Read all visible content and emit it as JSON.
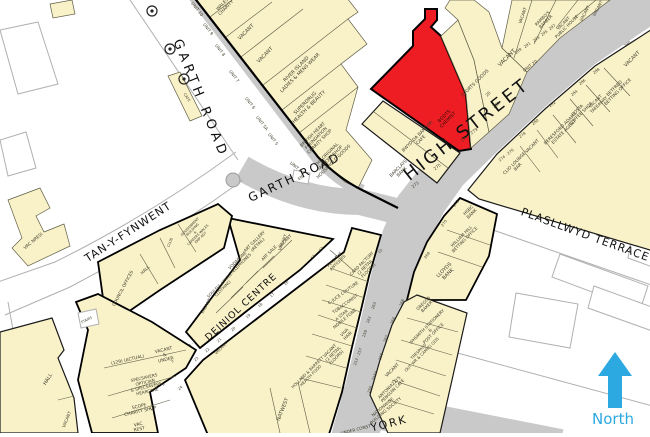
{
  "title": "Goad style retail plan - Bangor High Street",
  "palette": {
    "building": "#f9f2c9",
    "highlight": "#ee1c23",
    "road": "#c9c9c9",
    "north": "#2da9e1",
    "outline": "#5f5d45",
    "label": "#3f3c2a",
    "street": "#111111",
    "casing": "#b0b0b0"
  },
  "north": {
    "label": "North"
  },
  "highlighted_unit": {
    "name": "BOOTS CHEMIST",
    "address": "277 - 279 HIGH STREET"
  },
  "map": {
    "streets": [
      "GARTH ROAD",
      "HIGH STREET",
      "TAN-Y-FYNWENT",
      "PLASLLWYD TERRACE",
      "DEINIOL CENTRE",
      "YORK"
    ],
    "labels": [
      {
        "t": "GARTH ROAD",
        "x": 197,
        "y": 100,
        "r": 68,
        "s": 13,
        "ls": 4,
        "c": "#111111",
        "n": "street-label-garth-road-upper"
      },
      {
        "t": "GARTH ROAD",
        "x": 296,
        "y": 181,
        "r": -25,
        "s": 12,
        "ls": 2,
        "c": "#111111",
        "n": "street-label-garth-road"
      },
      {
        "t": "HIGH STREET",
        "x": 470,
        "y": 134,
        "r": -38,
        "s": 18,
        "ls": 3,
        "c": "#111111",
        "n": "street-label-high-street"
      },
      {
        "t": "TAN-Y-FYNWENT",
        "x": 130,
        "y": 235,
        "r": -33,
        "s": 11,
        "ls": 1,
        "c": "#111111",
        "n": "street-label-tan-y-fynwent"
      },
      {
        "t": "PLASLLWYD TERRACE",
        "x": 584,
        "y": 238,
        "r": 20,
        "s": 11,
        "ls": 1,
        "c": "#111111",
        "n": "street-label-plasllwyd-terrace"
      },
      {
        "t": "DEINIOL CENTRE",
        "x": 243,
        "y": 309,
        "r": -43,
        "s": 9.5,
        "ls": 1,
        "c": "#111111",
        "n": "street-label-deiniol-centre"
      },
      {
        "t": "YORK",
        "x": 390,
        "y": 427,
        "r": -14,
        "s": 11,
        "ls": 2,
        "c": "#111111",
        "n": "street-label-york"
      },
      {
        "t": "UNDER CONST",
        "x": 356,
        "y": 431,
        "r": -14,
        "s": 4.2,
        "n": "label-under-const"
      },
      {
        "t": "North",
        "x": 613,
        "y": 424,
        "r": 0,
        "s": 15,
        "c": "#2da9e1",
        "n": "north-label"
      },
      {
        "t": "WALES\nCHARITY",
        "x": 225,
        "y": 7,
        "r": -45,
        "s": 4.4
      },
      {
        "t": "VACANT",
        "x": 247,
        "y": 33,
        "r": -45,
        "s": 5
      },
      {
        "t": "VACANT",
        "x": 266,
        "y": 56,
        "r": -45,
        "s": 5
      },
      {
        "t": "RIVER ISLAND\nLADIES & MENS WEAR",
        "x": 299,
        "y": 72,
        "r": -45,
        "s": 4.8
      },
      {
        "t": "SUPERDRUG\nHEALTH & BEAUTY",
        "x": 308,
        "y": 106,
        "r": -45,
        "s": 4.8
      },
      {
        "t": "BRITISH HEART\nFOUNDATION\nCHARITY SHOP",
        "x": 317,
        "y": 139,
        "r": -45,
        "s": 4.4
      },
      {
        "t": "THE ORIGINAL\nFACTORY SHOP\nHOUSEHOLD GOODS",
        "x": 331,
        "y": 159,
        "r": -45,
        "s": 4.4
      },
      {
        "t": "UNIT 10",
        "x": 196,
        "y": 10,
        "r": 52,
        "s": 4.2
      },
      {
        "t": "UNIT 9",
        "x": 207,
        "y": 30,
        "r": 52,
        "s": 4.2
      },
      {
        "t": "UNIT 8",
        "x": 219,
        "y": 51,
        "r": 52,
        "s": 4.2
      },
      {
        "t": "UNIT 7",
        "x": 233,
        "y": 77,
        "r": 52,
        "s": 4.2
      },
      {
        "t": "UNIT 6",
        "x": 249,
        "y": 104,
        "r": 52,
        "s": 4.2
      },
      {
        "t": "UNIT 5A",
        "x": 261,
        "y": 124,
        "r": 52,
        "s": 4.2
      },
      {
        "t": "UNIT 5",
        "x": 272,
        "y": 140,
        "r": 52,
        "s": 4.2
      },
      {
        "t": "UNIT 4",
        "x": 295,
        "y": 168,
        "r": 40,
        "s": 4.2
      },
      {
        "t": "CAFE",
        "x": 186,
        "y": 98,
        "r": 56,
        "s": 3.6
      },
      {
        "t": "BOOTS\nCHEMIST",
        "x": 447,
        "y": 119,
        "r": -45,
        "s": 4.6,
        "c": "#2b0d08",
        "n": "highlight-label-boots-chemist"
      },
      {
        "t": "277 - 279",
        "x": 470,
        "y": 136,
        "r": -38,
        "s": 4.2
      },
      {
        "t": "BWYD DA BANGOR\nCAFE",
        "x": 420,
        "y": 139,
        "r": -45,
        "s": 4.4
      },
      {
        "t": "275",
        "x": 438,
        "y": 168,
        "r": -38,
        "s": 4.2
      },
      {
        "t": "BARCLAYS\nBANK",
        "x": 401,
        "y": 171,
        "r": -45,
        "s": 4.4
      },
      {
        "t": "273",
        "x": 416,
        "y": 186,
        "r": -38,
        "s": 4.2
      },
      {
        "t": "SPORTS GOODS",
        "x": 476,
        "y": 84,
        "r": -45,
        "s": 4.6
      },
      {
        "t": "20",
        "x": 489,
        "y": 95,
        "r": -45,
        "s": 4.2
      },
      {
        "t": "281",
        "x": 497,
        "y": 106,
        "r": -38,
        "s": 4.2
      },
      {
        "t": "VACANT",
        "x": 508,
        "y": 59,
        "r": -45,
        "s": 5.5
      },
      {
        "t": "UNIT 20",
        "x": 531,
        "y": 67,
        "r": -38,
        "s": 4.2
      },
      {
        "t": "VACANT",
        "x": 524,
        "y": 16,
        "r": -70,
        "s": 4.2
      },
      {
        "t": "RAMBO'S\nBARBER",
        "x": 545,
        "y": 21,
        "r": -45,
        "s": 4.2
      },
      {
        "t": "VACANT\nPUBLIC HOUSE",
        "x": 566,
        "y": 26,
        "r": -45,
        "s": 4.2
      },
      {
        "t": "VACANT",
        "x": 586,
        "y": 14,
        "r": -62,
        "s": 4.2
      },
      {
        "t": "VACANT",
        "x": 599,
        "y": 9,
        "r": -62,
        "s": 4.2
      },
      {
        "t": "VACANT",
        "x": 633,
        "y": 60,
        "r": -45,
        "s": 5
      },
      {
        "t": "289",
        "x": 519,
        "y": 52,
        "r": -38,
        "s": 3.8
      },
      {
        "t": "291",
        "x": 528,
        "y": 46,
        "r": -38,
        "s": 3.8
      },
      {
        "t": "293",
        "x": 537,
        "y": 40,
        "r": -38,
        "s": 3.8
      },
      {
        "t": "295",
        "x": 545,
        "y": 34,
        "r": -38,
        "s": 3.8
      },
      {
        "t": "297",
        "x": 553,
        "y": 28,
        "r": -38,
        "s": 3.8
      },
      {
        "t": "BETFRED\nBETTING OFFICE",
        "x": 617,
        "y": 91,
        "r": -45,
        "s": 4.4
      },
      {
        "t": "VACANT\nTAKEAWAY",
        "x": 598,
        "y": 104,
        "r": -45,
        "s": 4.2
      },
      {
        "t": "COSTA\nCOFFEE SHOP",
        "x": 580,
        "y": 113,
        "r": -45,
        "s": 4.4
      },
      {
        "t": "BERESFORD ADAMS\nESTATE AGENT",
        "x": 563,
        "y": 131,
        "r": -45,
        "s": 4.4
      },
      {
        "t": "VACANT",
        "x": 533,
        "y": 147,
        "r": -45,
        "s": 4.4
      },
      {
        "t": "CLIO LOUNGE\nBAR",
        "x": 517,
        "y": 166,
        "r": -45,
        "s": 4.4
      },
      {
        "t": "290",
        "x": 628,
        "y": 45,
        "r": -38,
        "s": 3.8
      },
      {
        "t": "288",
        "x": 597,
        "y": 72,
        "r": -38,
        "s": 3.8
      },
      {
        "t": "286",
        "x": 583,
        "y": 83,
        "r": -38,
        "s": 3.8
      },
      {
        "t": "284",
        "x": 575,
        "y": 94,
        "r": -38,
        "s": 3.8
      },
      {
        "t": "282",
        "x": 553,
        "y": 105,
        "r": -38,
        "s": 3.8
      },
      {
        "t": "280",
        "x": 536,
        "y": 123,
        "r": -38,
        "s": 3.8
      },
      {
        "t": "278",
        "x": 523,
        "y": 136,
        "r": -38,
        "s": 3.8
      },
      {
        "t": "274 - 276",
        "x": 507,
        "y": 156,
        "r": -38,
        "s": 3.8
      },
      {
        "t": "272",
        "x": 457,
        "y": 204,
        "r": -55,
        "s": 3.8
      },
      {
        "t": "270",
        "x": 445,
        "y": 224,
        "r": -55,
        "s": 3.8
      },
      {
        "t": "268",
        "x": 428,
        "y": 256,
        "r": -55,
        "s": 3.8
      },
      {
        "t": "HSBC\nBANK",
        "x": 471,
        "y": 213,
        "r": -45,
        "s": 4.4
      },
      {
        "t": "WILLIAM HILL\nBETTING OFFICE",
        "x": 464,
        "y": 239,
        "r": -45,
        "s": 4.2
      },
      {
        "t": "LLOYDS\nBANK",
        "x": 447,
        "y": 273,
        "r": -45,
        "s": 5
      },
      {
        "t": "GREGGS\nBAKER",
        "x": 426,
        "y": 306,
        "r": -45,
        "s": 4.2
      },
      {
        "t": "WHSMITH STATIONERY\n&\nPOST OFFICE",
        "x": 431,
        "y": 331,
        "r": -45,
        "s": 4.2
      },
      {
        "t": "TRESPASS\nOUT WR & CAMPG GDS",
        "x": 421,
        "y": 354,
        "r": -45,
        "s": 4
      },
      {
        "t": "VACANT",
        "x": 393,
        "y": 371,
        "r": -45,
        "s": 4.4
      },
      {
        "t": "ANTONIAZZI'S\nPENGUIN CAFE",
        "x": 392,
        "y": 390,
        "r": -45,
        "s": 4.2
      },
      {
        "t": "NATIONWIDE\nBUILDING SOCIETY",
        "x": 385,
        "y": 410,
        "r": -40,
        "s": 4.2
      },
      {
        "t": "266",
        "x": 403,
        "y": 303,
        "r": -70,
        "s": 3.8
      },
      {
        "t": "264",
        "x": 394,
        "y": 321,
        "r": -70,
        "s": 3.8
      },
      {
        "t": "262",
        "x": 387,
        "y": 339,
        "r": -70,
        "s": 3.8
      },
      {
        "t": "260",
        "x": 382,
        "y": 357,
        "r": -70,
        "s": 3.8
      },
      {
        "t": "258A",
        "x": 376,
        "y": 376,
        "r": -70,
        "s": 3.8
      },
      {
        "t": "256",
        "x": 371,
        "y": 390,
        "r": -70,
        "s": 3.8
      },
      {
        "t": "263",
        "x": 375,
        "y": 306,
        "r": -70,
        "s": 3.8
      },
      {
        "t": "261",
        "x": 370,
        "y": 320,
        "r": -70,
        "s": 3.8
      },
      {
        "t": "259",
        "x": 366,
        "y": 334,
        "r": -70,
        "s": 3.8
      },
      {
        "t": "253 - 257",
        "x": 359,
        "y": 357,
        "r": -70,
        "s": 3.8
      },
      {
        "t": "CARD FACTORY\n(2 RETAIL\nFLOORS)",
        "x": 366,
        "y": 268,
        "r": -45,
        "s": 4.2
      },
      {
        "t": "PETE THE\nANTIQUES",
        "x": 337,
        "y": 262,
        "r": -45,
        "s": 4
      },
      {
        "t": "C-JUCE COUTURE",
        "x": 344,
        "y": 294,
        "r": -36,
        "s": 4.2
      },
      {
        "t": "TOBACCONIST",
        "x": 346,
        "y": 305,
        "r": -36,
        "s": 4.2
      },
      {
        "t": "A STAR\nMOBILE FONE",
        "x": 344,
        "y": 318,
        "r": -40,
        "s": 4.2
      },
      {
        "t": "VIVA\nHAIR",
        "x": 347,
        "y": 335,
        "r": -45,
        "s": 4.2
      },
      {
        "t": "VACANT\n(2 RETAIL\nFLOORS)",
        "x": 334,
        "y": 355,
        "r": -45,
        "s": 4.2
      },
      {
        "t": "HOLLAND & BARRETT\nHEALTH FOOD",
        "x": 310,
        "y": 375,
        "r": -45,
        "s": 4
      },
      {
        "t": "NATWEST",
        "x": 284,
        "y": 410,
        "r": -68,
        "s": 5
      },
      {
        "t": "VACANT",
        "x": 284,
        "y": 243,
        "r": -68,
        "s": 4.2
      },
      {
        "t": "VACANT",
        "x": 222,
        "y": 349,
        "r": -45,
        "s": 4
      },
      {
        "t": "ENT",
        "x": 302,
        "y": 178,
        "r": -40,
        "s": 3.8
      },
      {
        "t": "12",
        "x": 322,
        "y": 250,
        "r": -43,
        "s": 3.8
      },
      {
        "t": "13",
        "x": 314,
        "y": 258,
        "r": -43,
        "s": 3.8
      },
      {
        "t": "15",
        "x": 381,
        "y": 252,
        "r": -43,
        "s": 3.8
      },
      {
        "t": "16",
        "x": 287,
        "y": 284,
        "r": -43,
        "s": 3.8
      },
      {
        "t": "17",
        "x": 273,
        "y": 296,
        "r": -43,
        "s": 3.8
      },
      {
        "t": "18",
        "x": 261,
        "y": 306,
        "r": -43,
        "s": 3.8
      },
      {
        "t": "19",
        "x": 249,
        "y": 317,
        "r": -43,
        "s": 3.8
      },
      {
        "t": "20",
        "x": 234,
        "y": 330,
        "r": -43,
        "s": 3.8
      },
      {
        "t": "21",
        "x": 220,
        "y": 341,
        "r": -43,
        "s": 3.8
      },
      {
        "t": "22",
        "x": 208,
        "y": 351,
        "r": -43,
        "s": 3.8
      },
      {
        "t": "23",
        "x": 197,
        "y": 360,
        "r": -43,
        "s": 3.8
      },
      {
        "t": "4 - 5",
        "x": 193,
        "y": 344,
        "r": -43,
        "s": 3.8
      },
      {
        "t": "24",
        "x": 181,
        "y": 389,
        "r": -43,
        "s": 3.8
      },
      {
        "t": "3",
        "x": 173,
        "y": 362,
        "r": -43,
        "s": 3.8
      },
      {
        "t": "2",
        "x": 164,
        "y": 385,
        "r": -43,
        "s": 3.8
      },
      {
        "t": "1",
        "x": 152,
        "y": 410,
        "r": -43,
        "s": 3.8
      },
      {
        "t": "ART GALLERY\n(RETAIL)",
        "x": 257,
        "y": 244,
        "r": -45,
        "s": 4.2
      },
      {
        "t": "ART SALE",
        "x": 270,
        "y": 254,
        "r": -45,
        "s": 4.2
      },
      {
        "t": "VACANT",
        "x": 286,
        "y": 242,
        "r": -45,
        "s": 4.2
      },
      {
        "t": "VODAFONE\nTELEPHONES",
        "x": 240,
        "y": 263,
        "r": -45,
        "s": 4.2
      },
      {
        "t": "SOULFUL LIVING\nCLOTHING",
        "x": 222,
        "y": 288,
        "r": -45,
        "s": 4
      },
      {
        "t": "VACANT",
        "x": 207,
        "y": 307,
        "r": -60,
        "s": 4.2
      },
      {
        "t": "VAC NRESI",
        "x": 34,
        "y": 242,
        "r": -40,
        "s": 4.4
      },
      {
        "t": "COUNCIL OFFICES",
        "x": 124,
        "y": 289,
        "r": -62,
        "s": 4.4
      },
      {
        "t": "HALL",
        "x": 146,
        "y": 271,
        "r": -45,
        "s": 4.2
      },
      {
        "t": "GOVERNMENT\nBUILDING\n&\nCAREERS WALES\nEMP AGY",
        "x": 196,
        "y": 233,
        "r": -45,
        "s": 3.4
      },
      {
        "t": "CLUB",
        "x": 171,
        "y": 243,
        "r": -68,
        "s": 3.6
      },
      {
        "t": "HALL",
        "x": 49,
        "y": 380,
        "r": -58,
        "s": 5
      },
      {
        "t": "VACANT",
        "x": 68,
        "y": 420,
        "r": -68,
        "s": 4.2
      },
      {
        "t": "STAIRS",
        "x": 87,
        "y": 321,
        "r": -25,
        "s": 3.4
      },
      {
        "t": "(129) (ACTUAL)",
        "x": 128,
        "y": 361,
        "r": -13,
        "s": 4.4
      },
      {
        "t": "VACANT\n&\nUNDER",
        "x": 165,
        "y": 356,
        "r": -13,
        "s": 4.4
      },
      {
        "t": "SPECSAVERS\nOPTICIAN\n& SPECSAVERS\nHEARCARE",
        "x": 146,
        "y": 386,
        "r": -13,
        "s": 4.2
      },
      {
        "t": "SCOPE\nCHARITY SHOP",
        "x": 140,
        "y": 410,
        "r": -13,
        "s": 4.4
      },
      {
        "t": "VAC\nREST",
        "x": 139,
        "y": 428,
        "r": -13,
        "s": 4.4
      }
    ]
  }
}
